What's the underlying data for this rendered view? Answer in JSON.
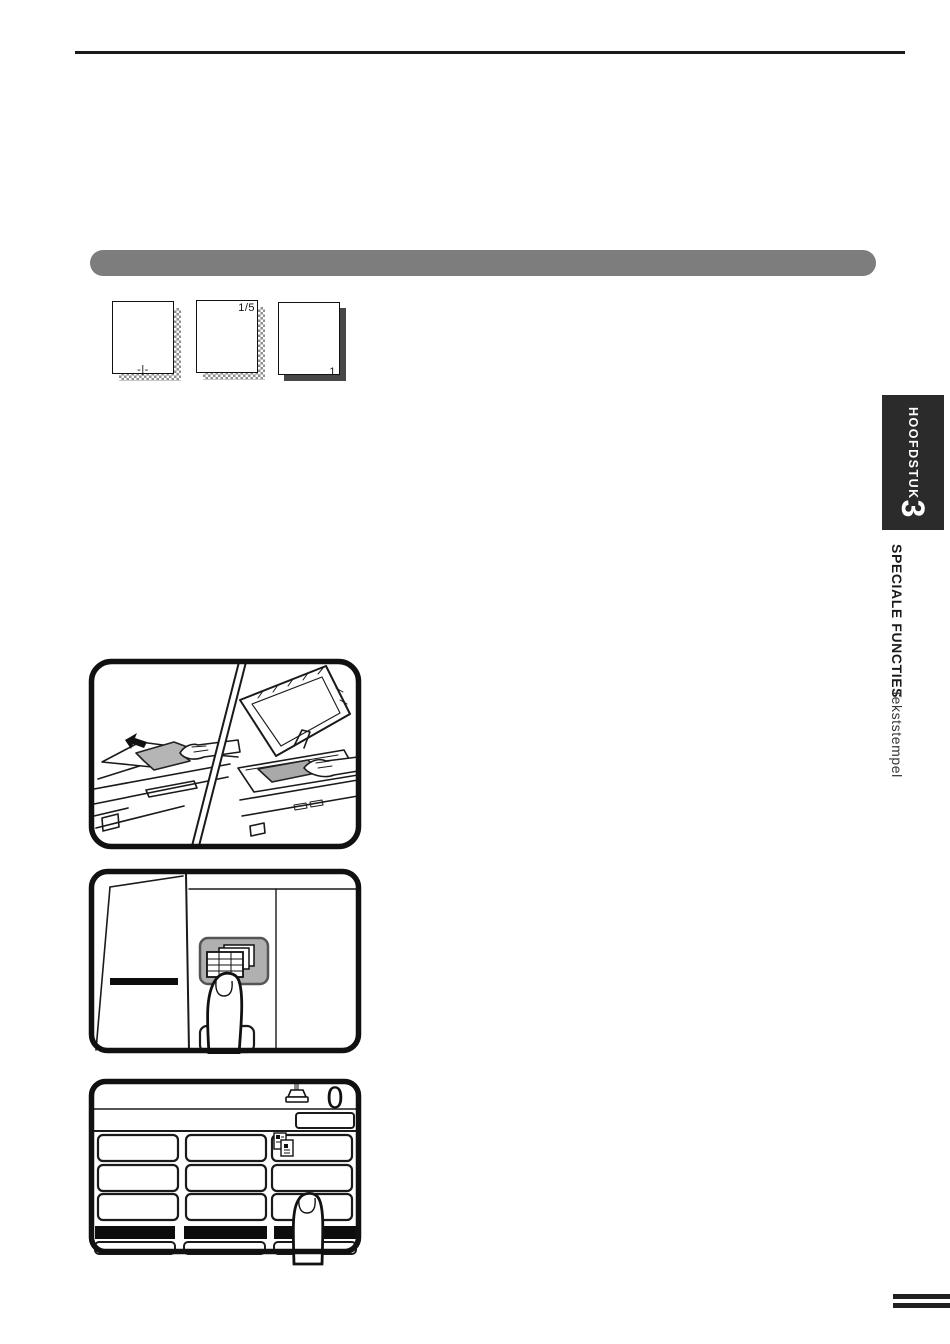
{
  "colors": {
    "section_bar_gray": "#7d7d7d",
    "chapter_tab_black": "#2b2b2b",
    "ink": "#1a1a1a"
  },
  "stamp_examples": {
    "center_page_number": "-|-",
    "page_of_total": "1/5",
    "corner_page_number": "1"
  },
  "chapter_tab": {
    "word": "HOOFDSTUK",
    "number": "3"
  },
  "side_caption": {
    "section": "SPECIALE FUNCTIES",
    "topic": "Tekststempel"
  },
  "touch_display": {
    "copy_counter": "0"
  },
  "icons": {
    "stamp_key": "stacked-pages-icon",
    "counter": "text-stamp-icon",
    "special_modes": "document-pages-icon",
    "feeder_arrow": "left-arrow-icon",
    "press_hand": "pointing-finger"
  }
}
